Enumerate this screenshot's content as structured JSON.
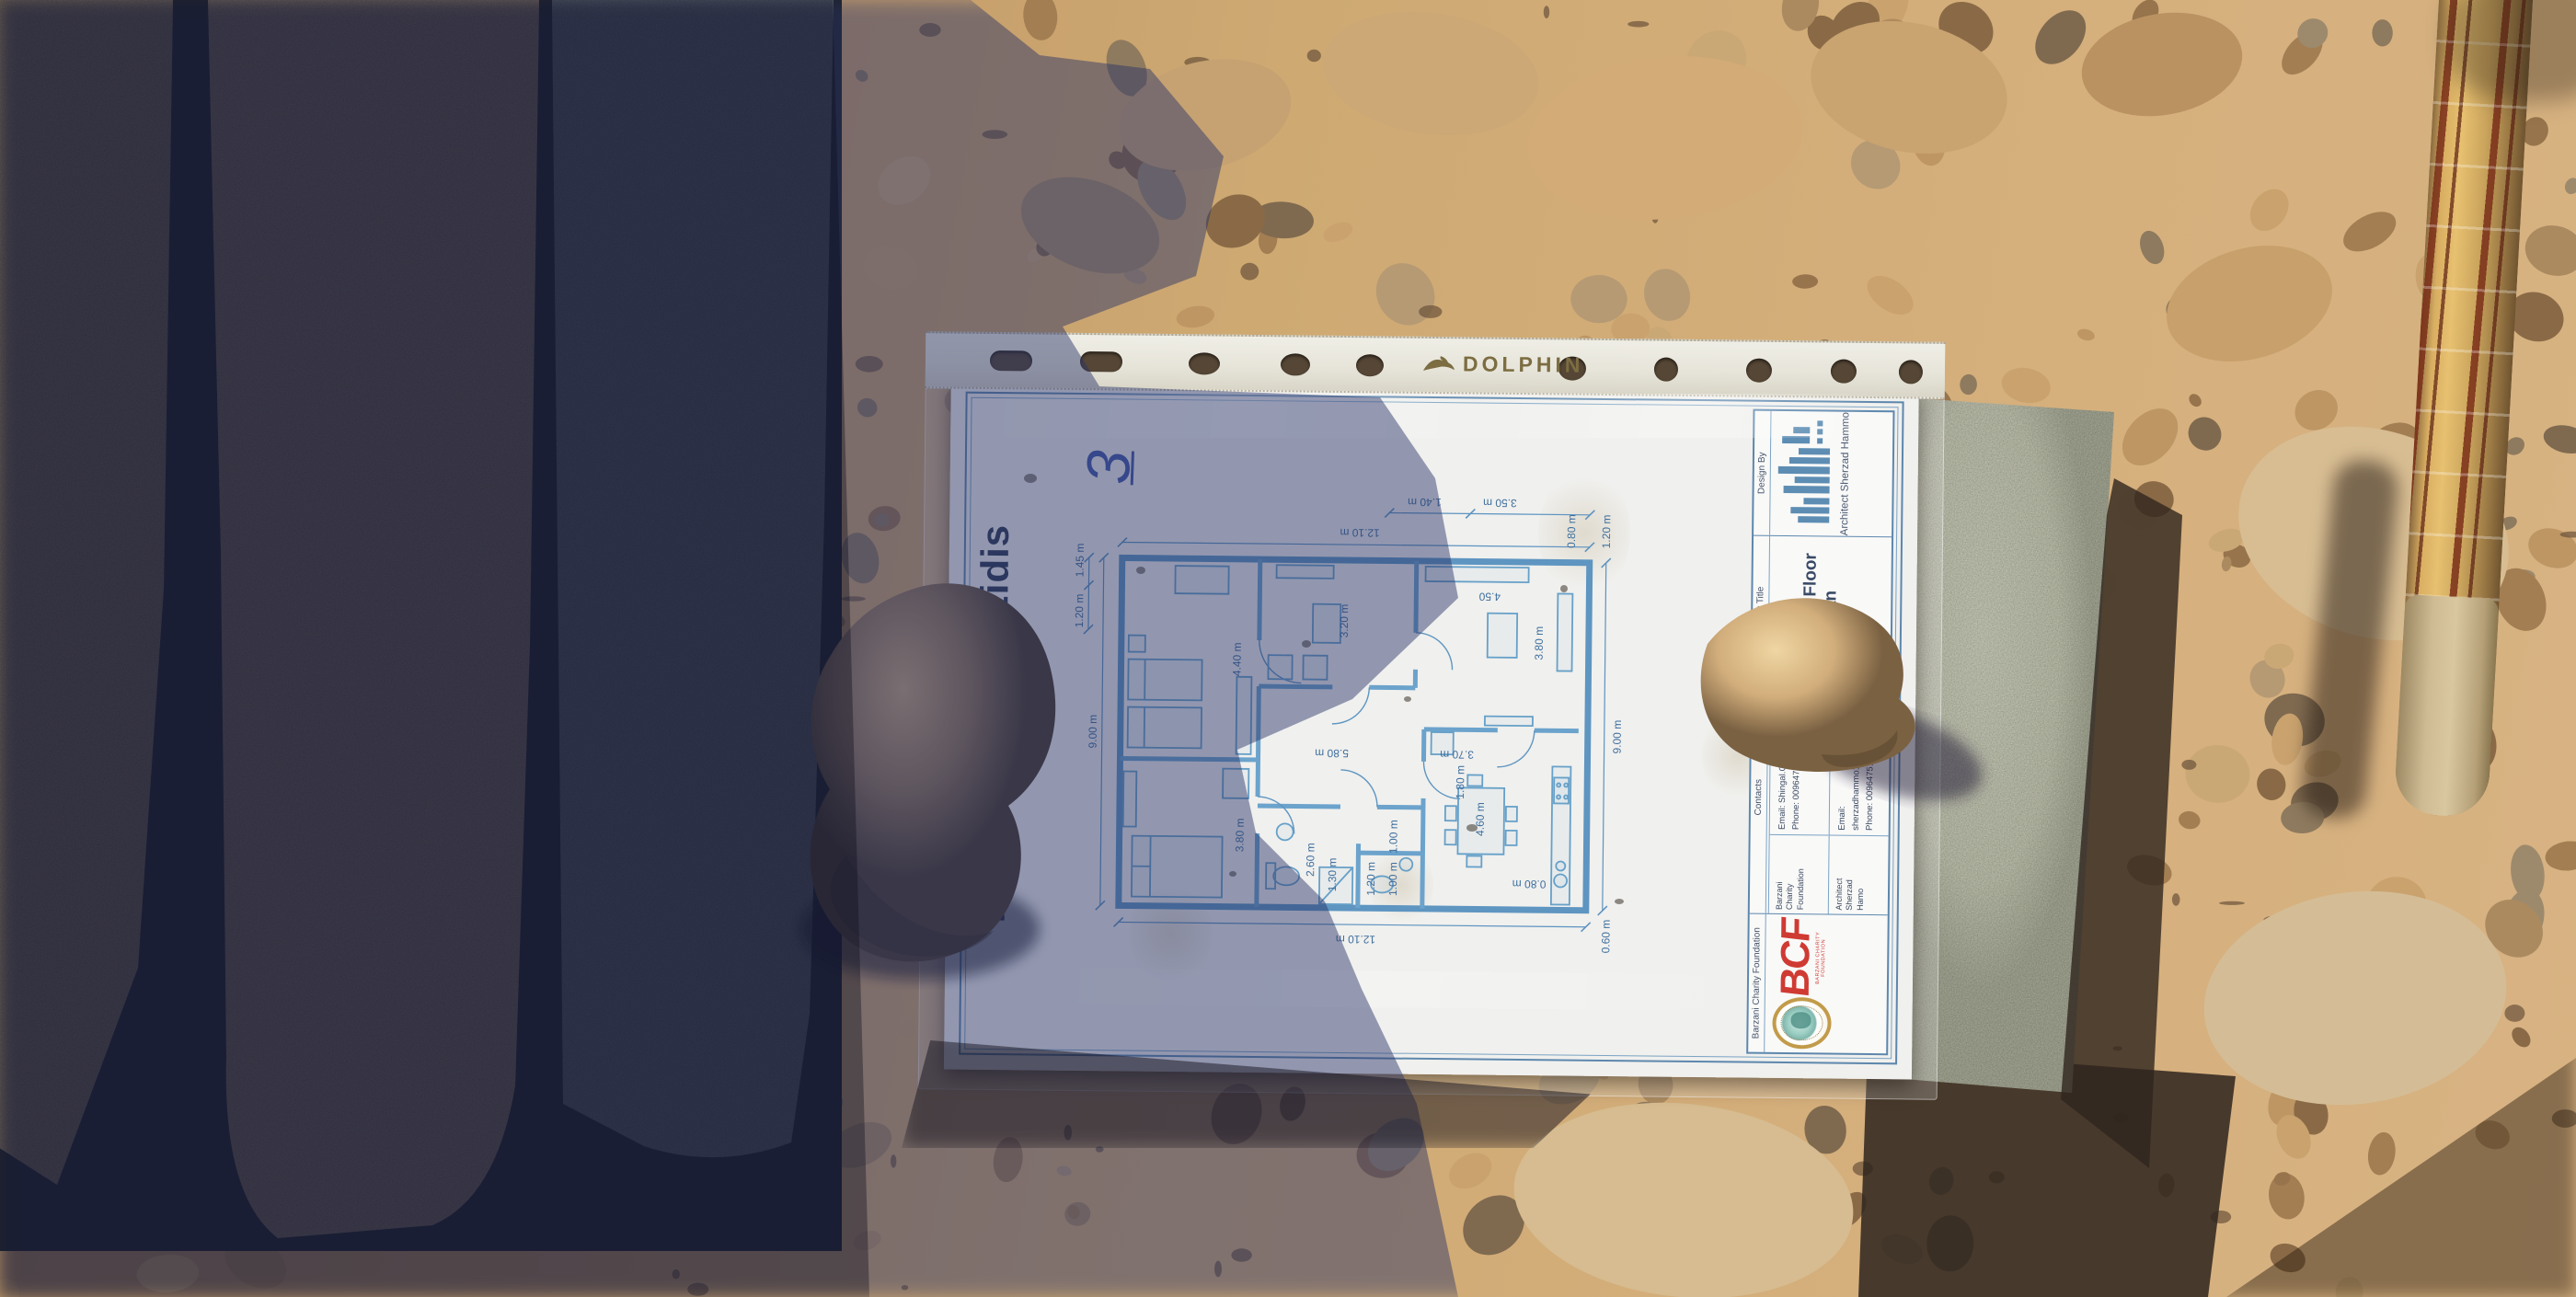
{
  "sleeve": {
    "brand": "DOLPHIN"
  },
  "note": "3",
  "sheet": {
    "title_left": "Plan R",
    "title_right": "r Yazidis",
    "dims": [
      "12.10 m",
      "12.10 m",
      "9.00 m",
      "9.00 m",
      "1.20 m",
      "1.45 m",
      "4.40 m",
      "3.80 m",
      "5.80 m",
      "3.20 m",
      "4.50",
      "3.80 m",
      "2.60 m",
      "1.30 m",
      "1.20 m",
      "1.00 m",
      "1.00 m",
      "3.70 m",
      "1.80 m",
      "4.60 m",
      "0.80 m",
      "0.80 m",
      "1.20 m",
      "3.50 m",
      "1.40 m",
      "0.60 m"
    ]
  },
  "title_block": {
    "design_label": "Design By",
    "design_name": "Architect Sherzad Hammo",
    "sheet_label": "Sheet Title",
    "sheet_value": "Ground Floor Plan",
    "contacts_label": "Contacts",
    "c1_org": "Barzani\nCharity\nFoundation",
    "c1_email": "Email: Shingal.Office@bcf.krd",
    "c1_phone": "Phone: 009647515019409",
    "c2_org": "Architect\nSherzad\nHamo",
    "c2_email": "Email: sherzadhammo1995@gmail.com",
    "c2_phone": "Phone: 009647510043276",
    "foundation_label": "Barzani Charity Foundation",
    "bcf_logo": "BCF",
    "bcf_caption": "BARZANI CHARITY FOUNDATION"
  },
  "colors": {
    "plan_line": "#4c86b4",
    "bcf_red": "#cf3a33",
    "pen_blue": "#2740a0",
    "logo_blue": "#5d8db3",
    "sunlit_gravel": "#d2ab77",
    "shadow_gravel": "#6b5844",
    "concrete_gray": "#5e6468",
    "slab_green_gray": "#c2c4b0",
    "rock_tan": "#d8b98a"
  }
}
